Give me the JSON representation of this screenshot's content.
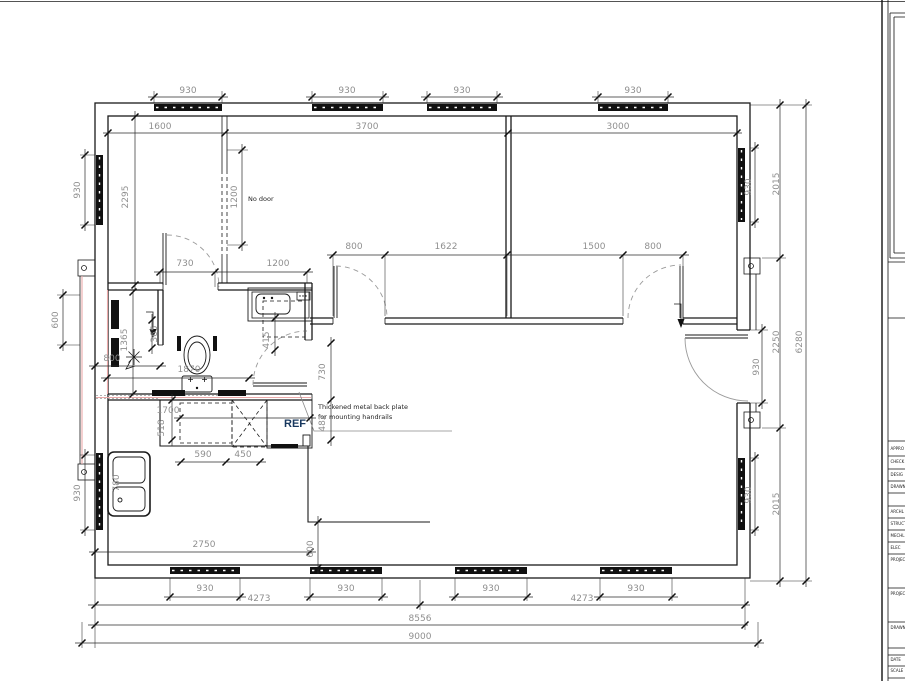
{
  "drawing": {
    "labels": {
      "no_door": "No door",
      "ref": "REF"
    },
    "note": {
      "line1": "Thickened metal back plate",
      "line2": "for mounting handrails"
    },
    "dims": {
      "top_windows": [
        "930",
        "930",
        "930",
        "930"
      ],
      "top_segments": [
        "1600",
        "3700",
        "3000"
      ],
      "interior_doors": [
        "800",
        "1622",
        "1500",
        "800"
      ],
      "bath_top": [
        "730",
        "1200"
      ],
      "left_window_top": "930",
      "left_room_height": "2295",
      "no_door_opening": "1200",
      "left_porch": "600",
      "left_window_bottom": "930",
      "shower_length": "1365",
      "shower_seg": "365",
      "shower_width": "800",
      "toilet_offset": "1870",
      "vanity_depth": "415",
      "bath_door": "730",
      "ref_depth": "482",
      "counter_width": "1700",
      "counter_depth": "518",
      "counter_590": "590",
      "counter_450": "450",
      "sink_width": "780",
      "kitchen_width": "2750",
      "kitchen_step": "600",
      "bottom_windows": [
        "930",
        "930",
        "930",
        "930"
      ],
      "bottom_segments": [
        "4273",
        "4273"
      ],
      "bottom_wall": "8556",
      "bottom_overall": "9000",
      "right_top": "2015",
      "right_window_top": "930",
      "right_door": "930",
      "right_middle": "2250",
      "right_bottom": "2015",
      "right_overall": "6280",
      "right_window_bottom": "930"
    },
    "colors": {
      "line": "#1a1a1a",
      "dim_text": "#8f8f8f",
      "accent": "#eaa9a9",
      "ref_text": "#17375e"
    },
    "titleblock": {
      "rows": [
        "APPRO",
        "CHECK",
        "DESIG",
        "DRAWN",
        "ARCHL",
        "STRUCT",
        "MECHL",
        "ELEC",
        "PROJECT",
        "PROJECT",
        "DRAWN",
        "DATE",
        "SCALE"
      ]
    }
  }
}
